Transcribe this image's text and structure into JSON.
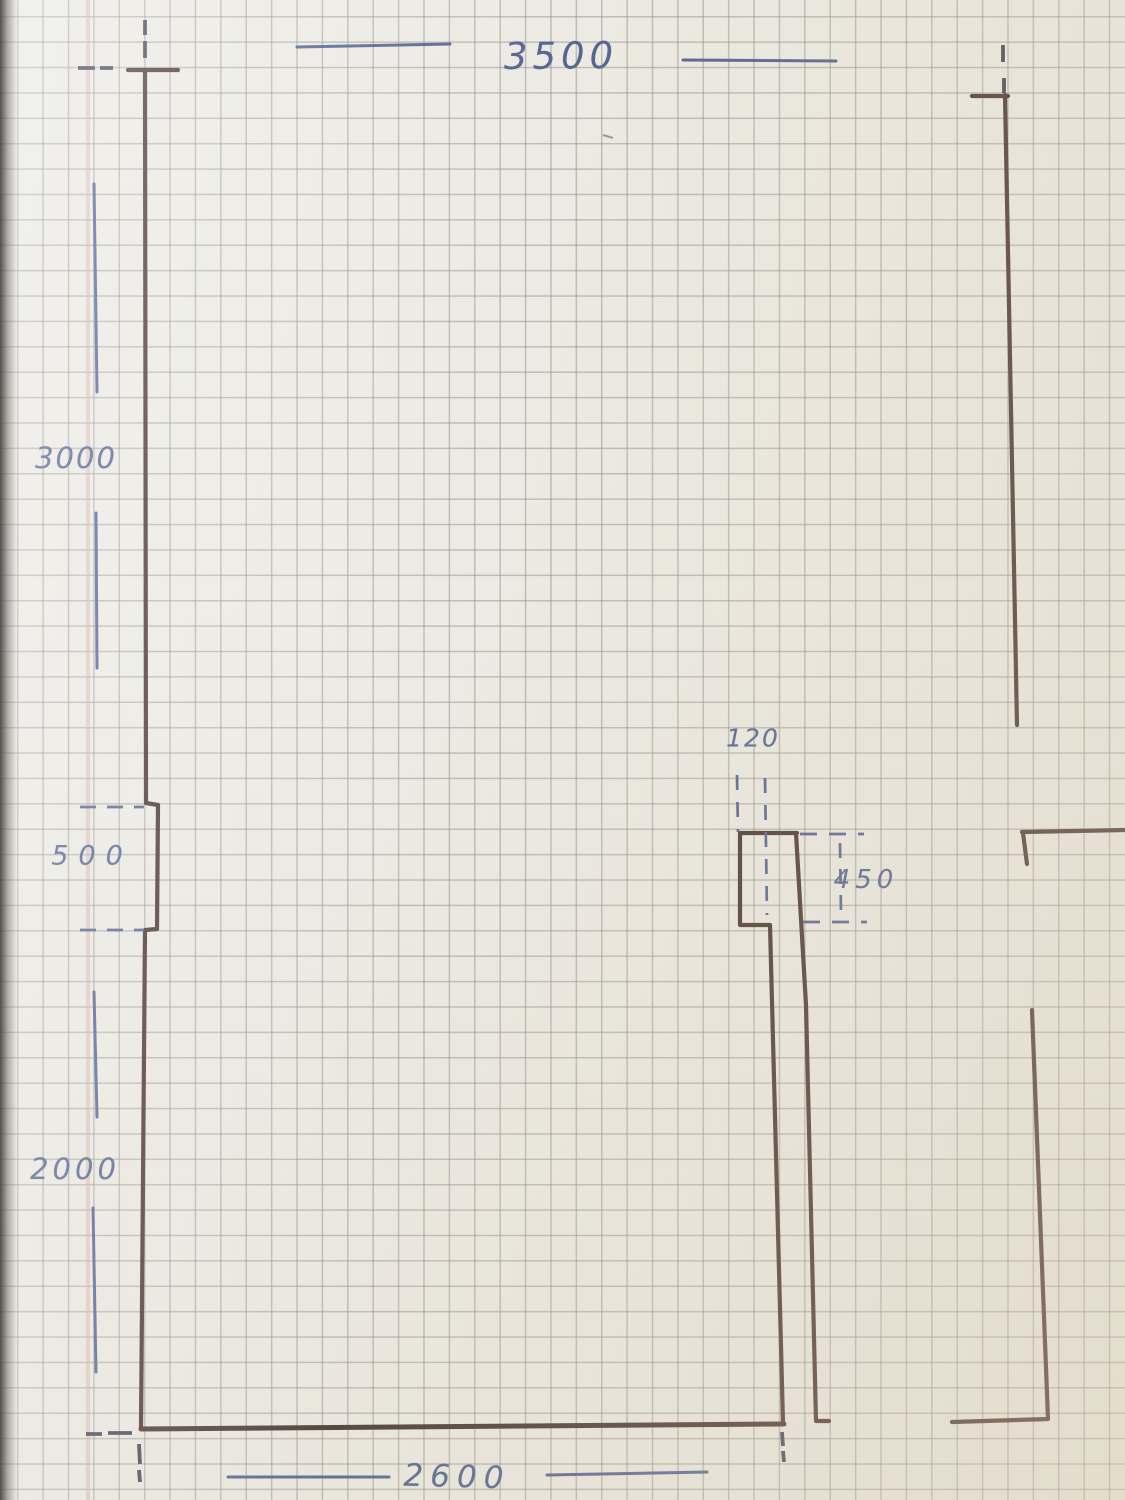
{
  "sketch": {
    "description": "Hand-drawn floor plan sketch in ink on squared graph paper",
    "colors": {
      "paper": "#eae8e0",
      "grid": "#7c7972",
      "wall_ink": "#2a130d",
      "pen_ink": "#33487e",
      "margin_line": "#ce9a94"
    },
    "dimensions": {
      "top_width": "3500",
      "left_upper_height": "3000",
      "left_recess_height": "500",
      "left_lower_height": "2000",
      "wall_thickness": "120",
      "recess_depth": "450",
      "bottom_width": "2600"
    }
  }
}
